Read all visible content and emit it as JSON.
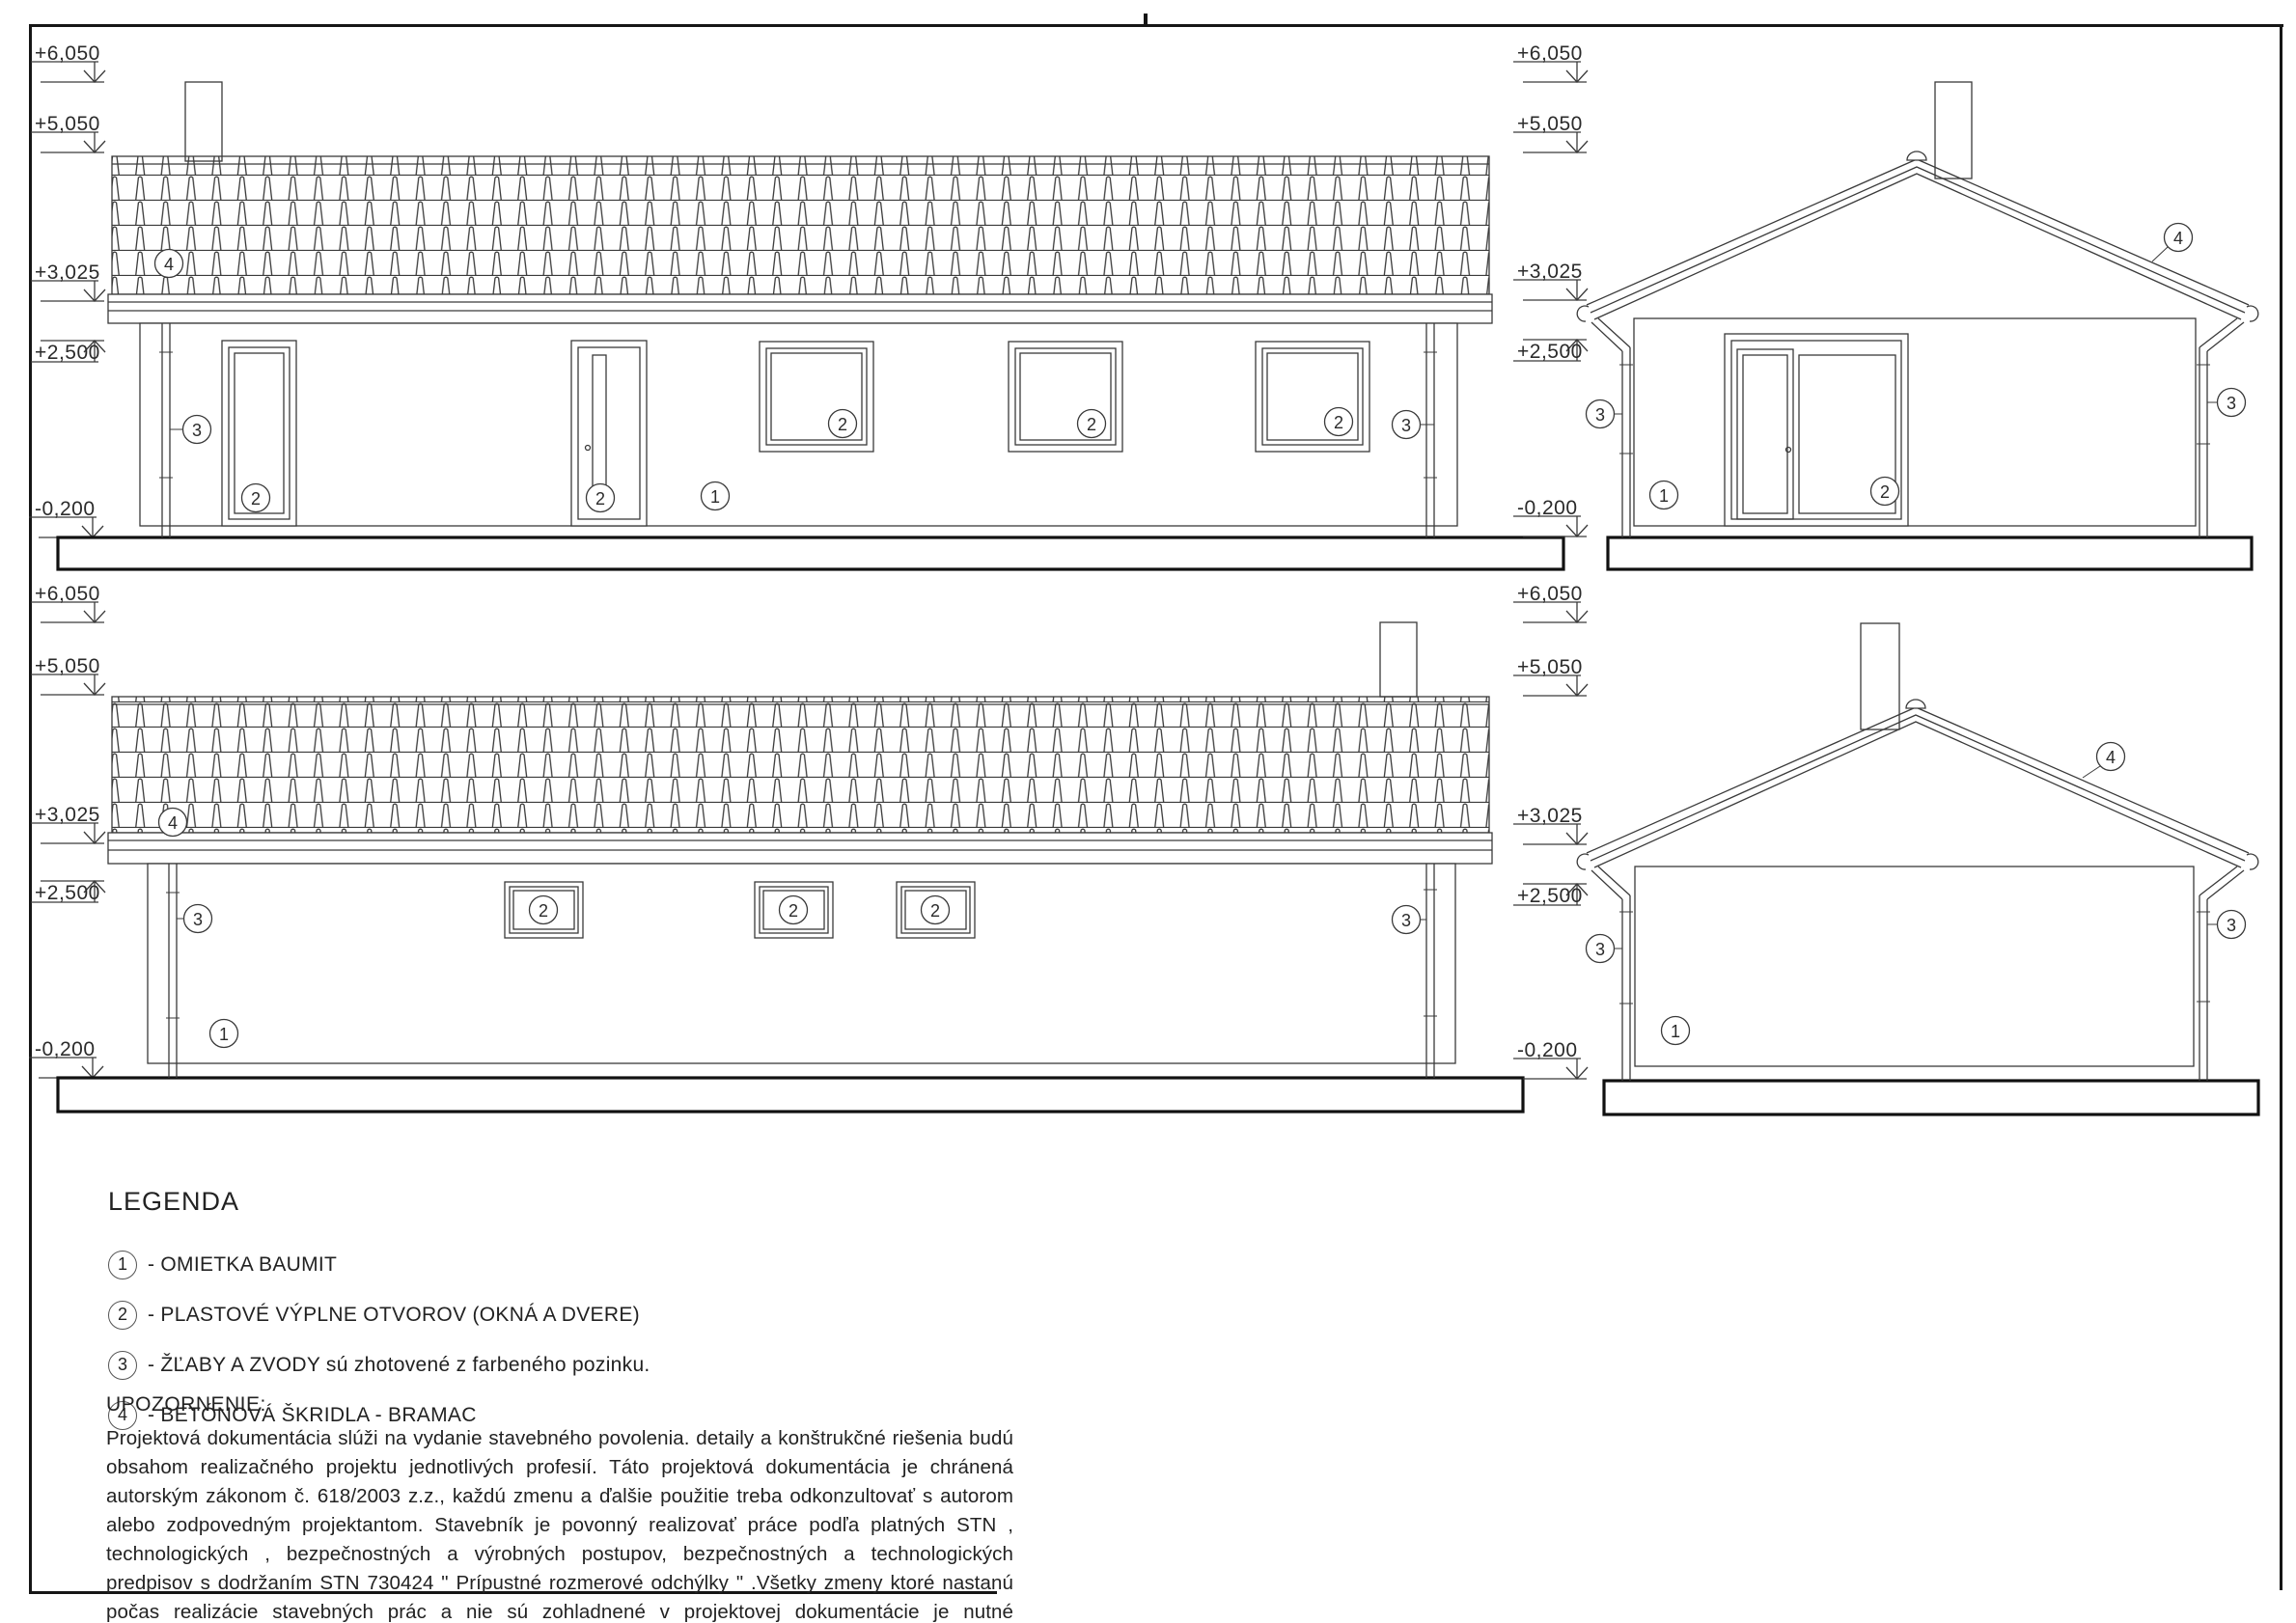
{
  "sheet": {
    "levels": {
      "v6050": "+6,050",
      "v5050": "+5,050",
      "v3025": "+3,025",
      "v2500": "+2,500",
      "vm0200": "-0,200"
    },
    "callouts": {
      "c1": "1",
      "c2": "2",
      "c3": "3",
      "c4": "4"
    },
    "legend": {
      "title": "LEGENDA",
      "items": [
        {
          "num": "1",
          "text": "- OMIETKA BAUMIT"
        },
        {
          "num": "2",
          "text": "- PLASTOVÉ VÝPLNE OTVOROV (OKNÁ A DVERE)"
        },
        {
          "num": "3",
          "text": "- ŽĽABY A ZVODY sú zhotovené z farbeného pozinku."
        },
        {
          "num": "4",
          "text": "- BETÓNOVÁ ŠKRIDLA - BRAMAC"
        }
      ]
    },
    "notes": {
      "title": "UPOZORNENIE:",
      "body": "Projektová dokumentácia slúži na vydanie stavebného povolenia. detaily a konštrukčné riešenia budú obsahom realizačného projektu jednotlivých profesií. Táto projektová dokumentácia je chránená autorským zákonom č. 618/2003 z.z., každú zmenu a ďalšie použitie treba odkonzultovať s autorom alebo zodpovedným projektantom. Stavebník je povonný realizovať práce podľa platných STN , technologických , bezpečnostných a výrobných postupov, bezpečnostných a technologických predpisov s dodržaním STN 730424 \" Prípustné rozmerové odchýlky \" .Všetky zmeny ktoré nastanú počas realizácie stavebných prác a nie sú zohladnené v projektovej dokumentácie je nutné konzultovať s hlavným projektantom."
    }
  }
}
